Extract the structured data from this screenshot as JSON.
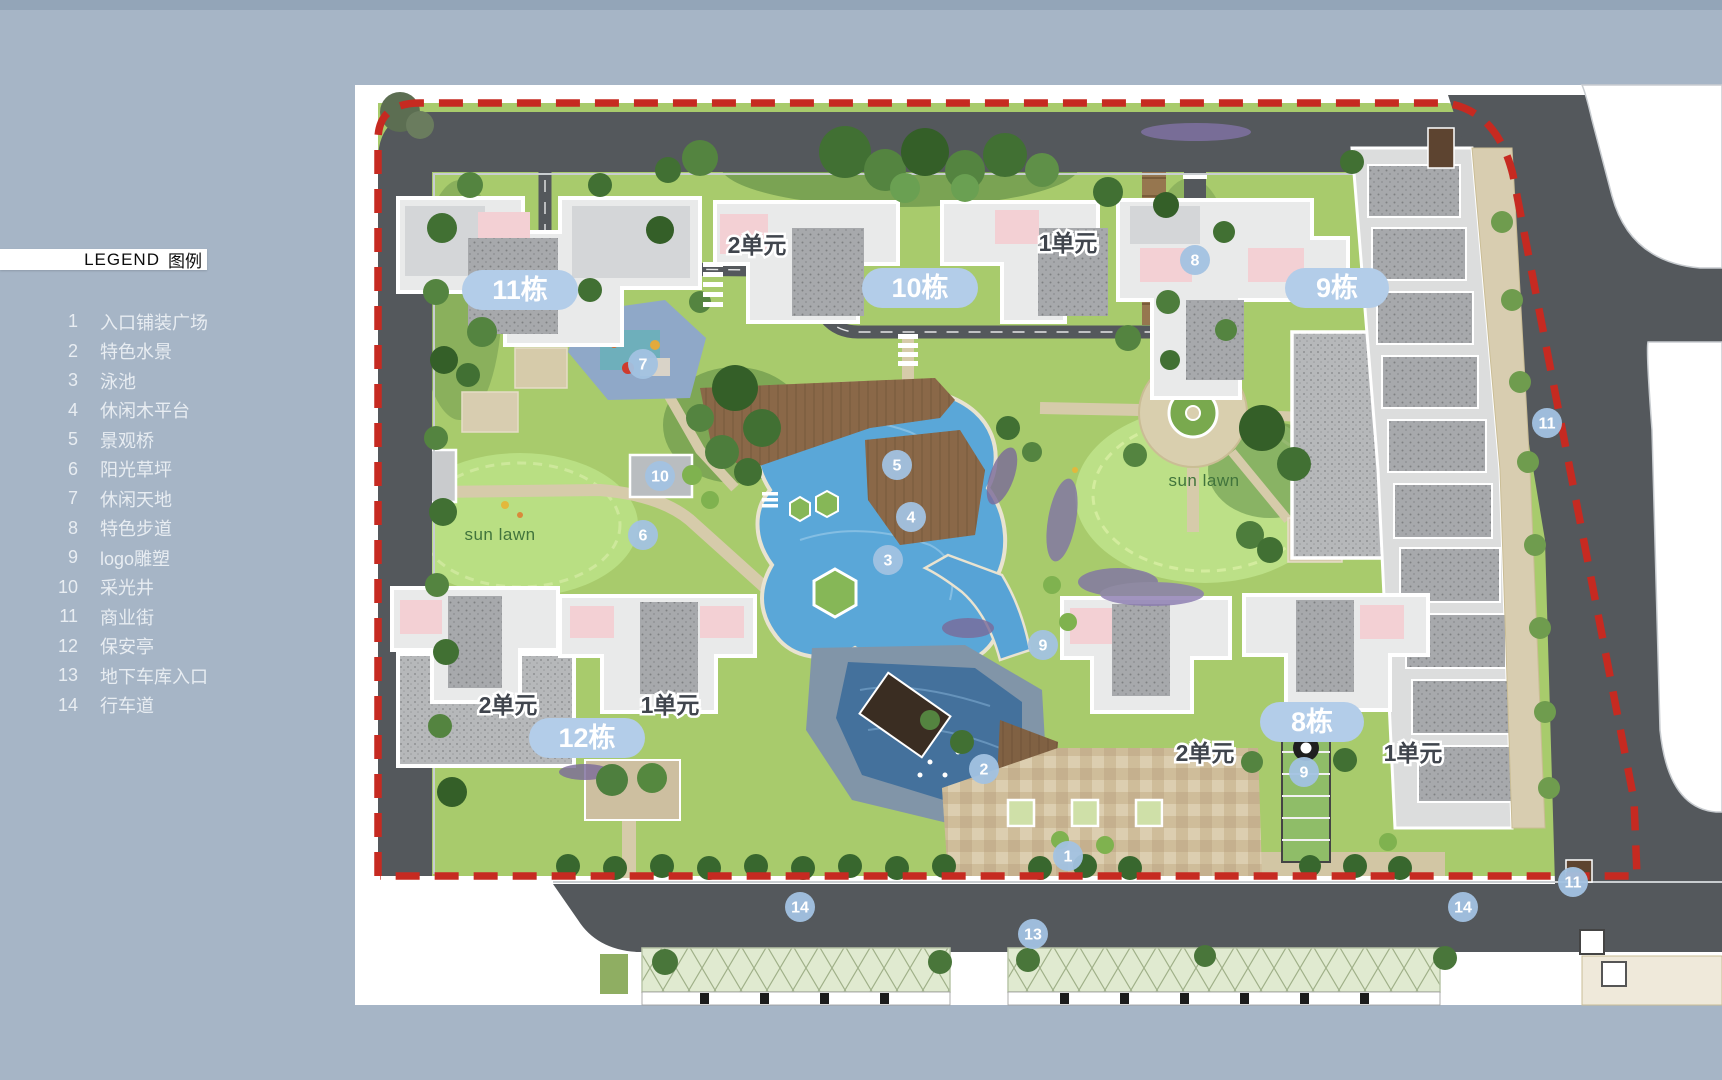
{
  "legend": {
    "title_en": "LEGEND",
    "title_zh": "图例",
    "items": [
      {
        "num": "1",
        "label": "入口铺装广场"
      },
      {
        "num": "2",
        "label": "特色水景"
      },
      {
        "num": "3",
        "label": "泳池"
      },
      {
        "num": "4",
        "label": "休闲木平台"
      },
      {
        "num": "5",
        "label": "景观桥"
      },
      {
        "num": "6",
        "label": "阳光草坪"
      },
      {
        "num": "7",
        "label": "休闲天地"
      },
      {
        "num": "8",
        "label": "特色步道"
      },
      {
        "num": "9",
        "label": "logo雕塑"
      },
      {
        "num": "10",
        "label": "采光井"
      },
      {
        "num": "11",
        "label": "商业街"
      },
      {
        "num": "12",
        "label": "保安亭"
      },
      {
        "num": "13",
        "label": "地下车库入口"
      },
      {
        "num": "14",
        "label": "行车道"
      }
    ]
  },
  "map": {
    "building_labels": [
      {
        "text": "11栋",
        "x": 520,
        "y": 290
      },
      {
        "text": "10栋",
        "x": 920,
        "y": 288
      },
      {
        "text": "9栋",
        "x": 1337,
        "y": 288
      },
      {
        "text": "12栋",
        "x": 587,
        "y": 738
      },
      {
        "text": "8栋",
        "x": 1312,
        "y": 722
      }
    ],
    "unit_labels": [
      {
        "text": "2单元",
        "x": 757,
        "y": 245
      },
      {
        "text": "1单元",
        "x": 1068,
        "y": 243
      },
      {
        "text": "2单元",
        "x": 508,
        "y": 705
      },
      {
        "text": "1单元",
        "x": 670,
        "y": 705
      },
      {
        "text": "2单元",
        "x": 1205,
        "y": 753
      },
      {
        "text": "1单元",
        "x": 1413,
        "y": 753
      }
    ],
    "markers": [
      {
        "num": "1",
        "x": 1068,
        "y": 856
      },
      {
        "num": "2",
        "x": 984,
        "y": 769
      },
      {
        "num": "3",
        "x": 888,
        "y": 560
      },
      {
        "num": "4",
        "x": 911,
        "y": 517
      },
      {
        "num": "5",
        "x": 897,
        "y": 465
      },
      {
        "num": "6",
        "x": 643,
        "y": 535
      },
      {
        "num": "7",
        "x": 643,
        "y": 364
      },
      {
        "num": "8",
        "x": 1195,
        "y": 260
      },
      {
        "num": "9",
        "x": 1043,
        "y": 645
      },
      {
        "num": "9",
        "x": 1304,
        "y": 772
      },
      {
        "num": "10",
        "x": 660,
        "y": 476
      },
      {
        "num": "11",
        "x": 1547,
        "y": 423
      },
      {
        "num": "11",
        "x": 1573,
        "y": 882
      },
      {
        "num": "13",
        "x": 1033,
        "y": 934
      },
      {
        "num": "14",
        "x": 800,
        "y": 907
      },
      {
        "num": "14",
        "x": 1463,
        "y": 907
      }
    ],
    "annotations": [
      {
        "text": "sun lawn",
        "x": 500,
        "y": 540
      },
      {
        "text": "sun lawn",
        "x": 1204,
        "y": 486
      }
    ],
    "colors": {
      "boundary_red": "#c62a21",
      "road": "#54585c",
      "lawn": "#a8cb6c",
      "pool": "#5aa7d8",
      "label_pill": "#b3cde9",
      "marker_fill": "#a2c2e2",
      "building": "#e9eaea",
      "paving": "#cfbd9a",
      "deck": "#8a6848"
    }
  }
}
